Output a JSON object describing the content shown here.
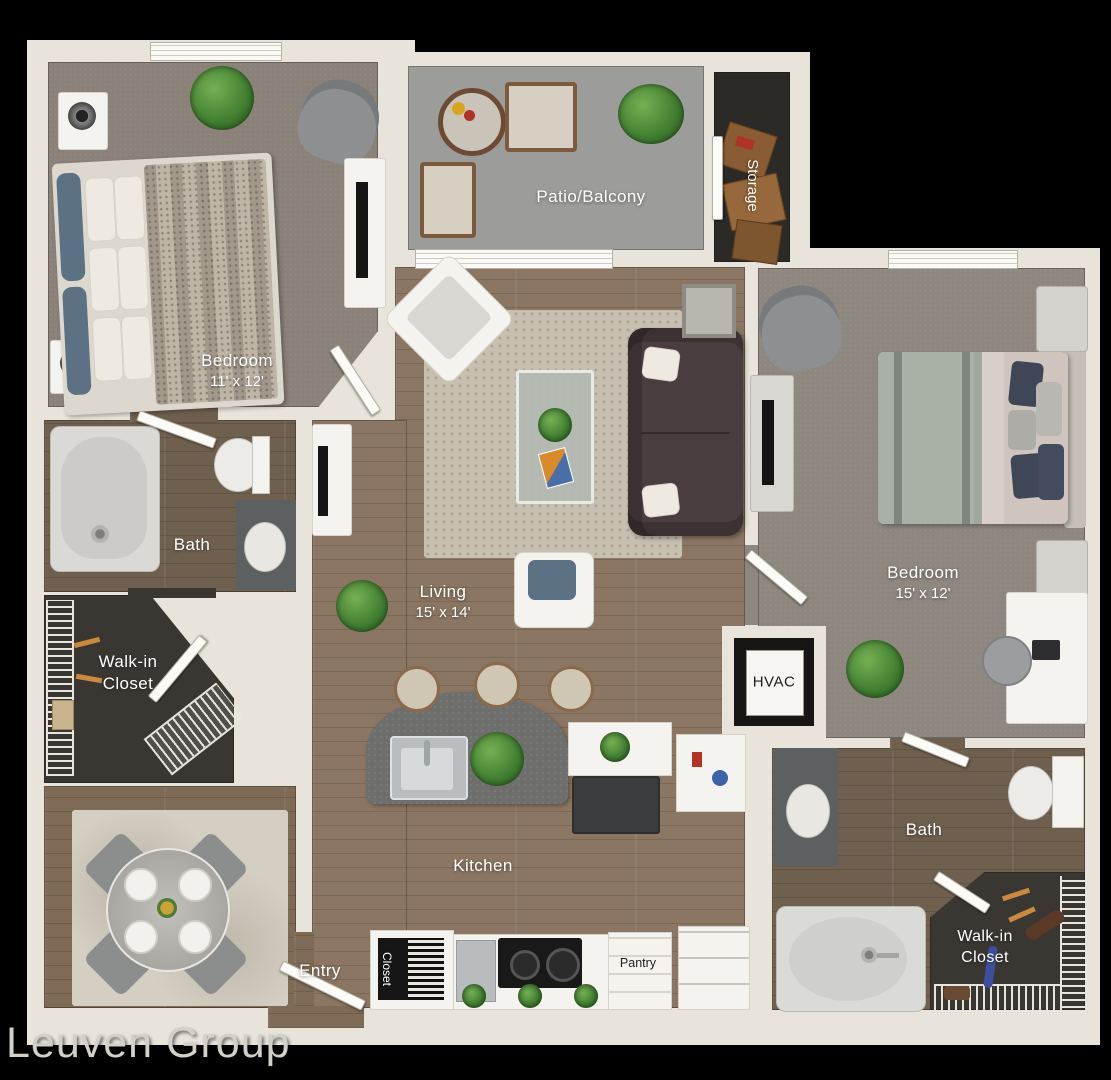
{
  "watermark": "Leuven Group",
  "rooms": {
    "bedroom_left": {
      "label": "Bedroom",
      "dims": "11' x 12'"
    },
    "patio": {
      "label": "Patio/Balcony"
    },
    "storage": {
      "label": "Storage"
    },
    "living": {
      "label": "Living",
      "dims": "15' x 14'"
    },
    "bath_left": {
      "label": "Bath"
    },
    "walkin_left": {
      "line1": "Walk-in",
      "line2": "Closet"
    },
    "kitchen": {
      "label": "Kitchen"
    },
    "entry": {
      "label": "Entry"
    },
    "entry_closet": {
      "label": "Closet"
    },
    "pantry": {
      "label": "Pantry"
    },
    "hvac": {
      "label": "HVAC"
    },
    "bedroom_right": {
      "label": "Bedroom",
      "dims": "15' x 12'"
    },
    "bath_right": {
      "label": "Bath"
    },
    "walkin_right": {
      "line1": "Walk-in",
      "line2": "Closet"
    }
  },
  "colors": {
    "background": "#000000",
    "wall": "#e8e4dc",
    "carpet_left_bedroom": "#8a8179",
    "carpet_right_bedroom": "#8e8780",
    "patio_concrete": "#9c9c9a",
    "wood_floor": "#8b7663",
    "bath_wood": "#6f5f4e",
    "closet_floor": "#3a3733",
    "island_counter": "#6e6e6c",
    "sofa_leather": "#4a3d3f",
    "accent_blue_pillow": "#5d7184",
    "plant_green": "#4e8f3a",
    "label_text": "#ffffff",
    "dark_label_text": "#1d1d1d",
    "watermark_text": "#d3d0ca"
  }
}
